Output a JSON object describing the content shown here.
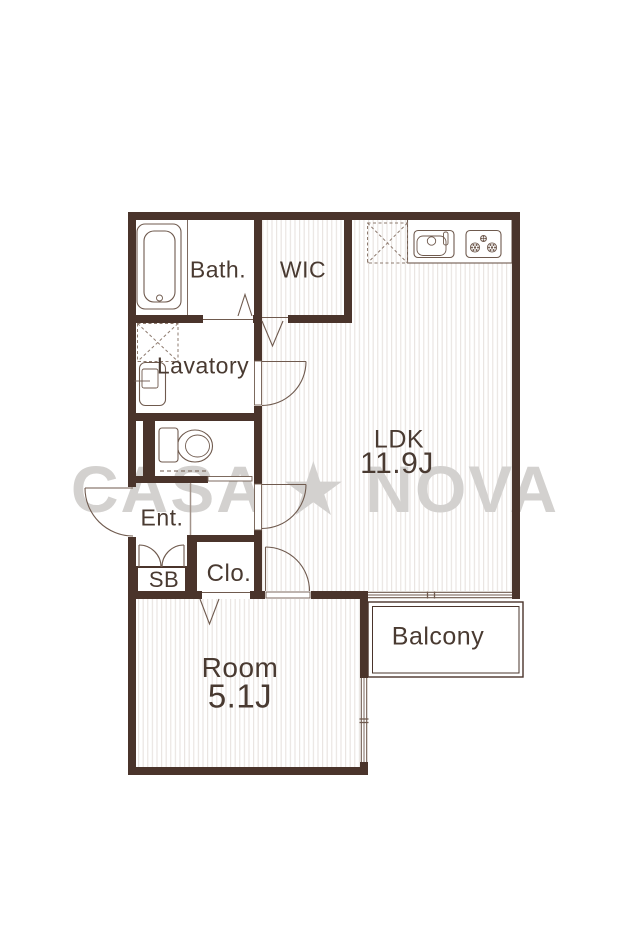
{
  "watermark": {
    "text": "CASA ★ NOVA"
  },
  "rooms": {
    "bath": {
      "label": "Bath."
    },
    "wic": {
      "label": "WIC"
    },
    "lavatory": {
      "label": "Lavatory"
    },
    "ldk": {
      "label": "LDK",
      "size": "11.9J"
    },
    "ent": {
      "label": "Ent."
    },
    "sb": {
      "label": "SB"
    },
    "clo": {
      "label": "Clo."
    },
    "room": {
      "label": "Room",
      "size": "5.1J"
    },
    "balcony": {
      "label": "Balcony"
    }
  },
  "icons": [
    "bathtub-icon",
    "kitchen-sink-icon",
    "stove-icon",
    "toilet-icon",
    "lavatory-sink-icon",
    "refrigerator-space-icon",
    "washing-machine-space-icon",
    "door-swing-icon",
    "folding-door-icon",
    "sliding-door-icon",
    "window-icon",
    "star-icon"
  ],
  "colors": {
    "wall": "#4a342b",
    "text": "#493a31",
    "fixture_line": "#6f5a4e",
    "hatch": "#e9e4e1",
    "watermark": "#d3d1cf",
    "background": "#ffffff"
  }
}
